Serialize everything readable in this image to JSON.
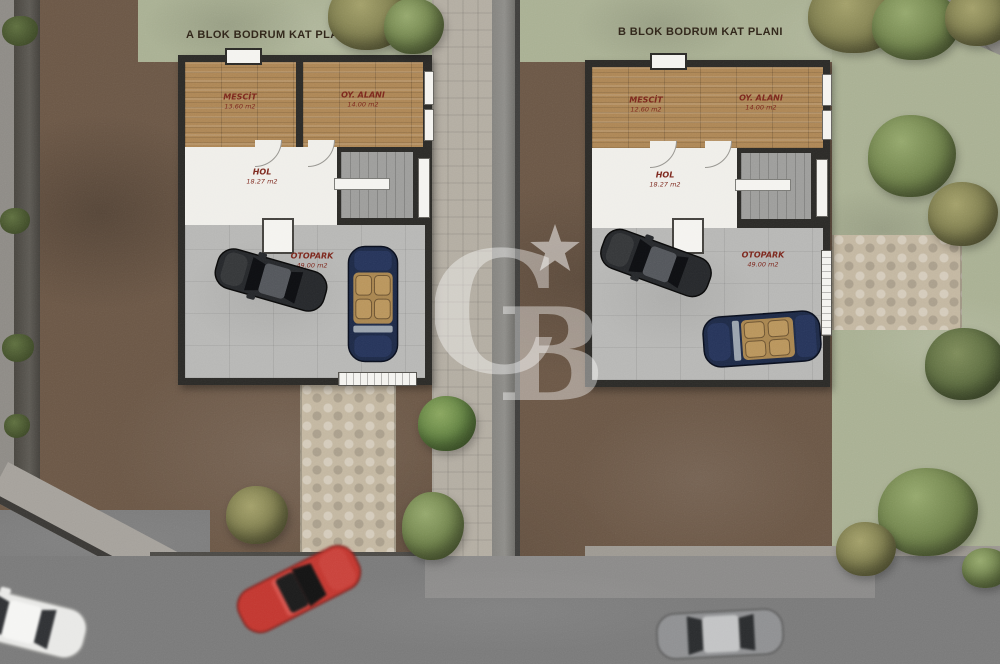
{
  "blocks": [
    {
      "title": "A BLOK BODRUM KAT PLANI",
      "rooms": [
        {
          "name": "MESCİT",
          "area": "13.60 m2"
        },
        {
          "name": "OY. ALANI",
          "area": "14.00 m2"
        },
        {
          "name": "HOL",
          "area": "18.27 m2"
        },
        {
          "name": "OTOPARK",
          "area": "49.00 m2"
        }
      ]
    },
    {
      "title": "B BLOK BODRUM KAT PLANI",
      "rooms": [
        {
          "name": "MESCİT",
          "area": "12.60 m2"
        },
        {
          "name": "OY. ALANI",
          "area": "14.00 m2"
        },
        {
          "name": "HOL",
          "area": "18.27 m2"
        },
        {
          "name": "OTOPARK",
          "area": "49.00 m2"
        }
      ]
    }
  ],
  "watermark": {
    "letter_c": "C",
    "letter_b": "B",
    "color": "#ffffff"
  },
  "colors": {
    "dirt": "#6b5746",
    "grass": "#a9b093",
    "road": "#7a7a7a",
    "wood_floor": "#ad8655",
    "concrete_floor": "#b7b7b5",
    "wall": "#2b2a27",
    "room_label_text": "#7c261c",
    "title_text": "#2f2519",
    "car_navy": "#1e2a47",
    "car_red": "#c23730",
    "path_stone": "#c3b7a1"
  }
}
